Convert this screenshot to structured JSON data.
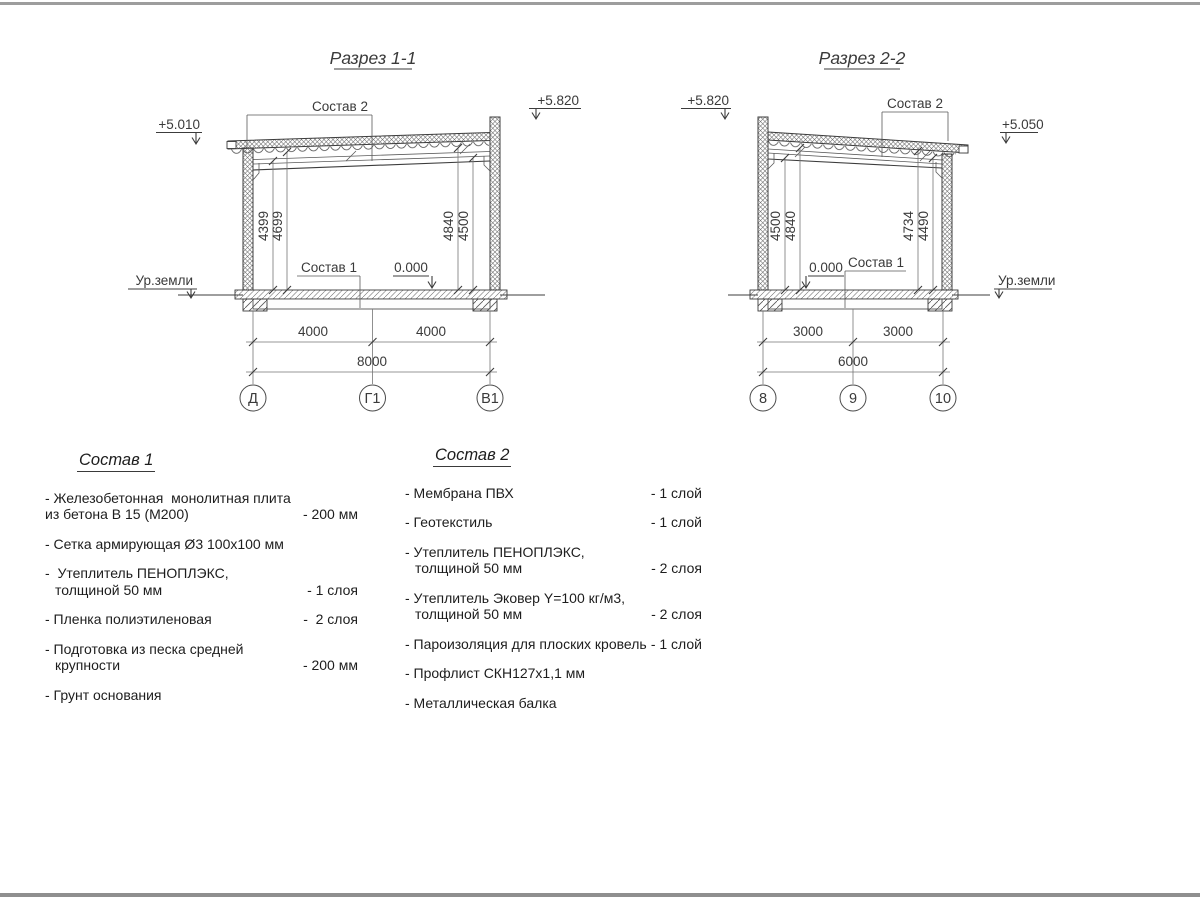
{
  "sections": [
    {
      "title": "Разрез 1-1",
      "elev_left": "+5.010",
      "elev_right": "+5.820",
      "roof_callout": "Состав 2",
      "floor_callout": "Состав 1",
      "zero_mark": "0.000",
      "ground_label": "Ур.земли",
      "dim_labels": {
        "left_inner": [
          "4399",
          "4699"
        ],
        "right_inner": [
          "4840",
          "4500"
        ],
        "span1": "4000",
        "span2": "4000",
        "total": "8000"
      },
      "axes": [
        "Д",
        "Г1",
        "В1"
      ]
    },
    {
      "title": "Разрез 2-2",
      "elev_left": "+5.820",
      "elev_right": "+5.050",
      "roof_callout": "Состав 2",
      "floor_callout": "Состав 1",
      "zero_mark": "0.000",
      "ground_label": "Ур.земли",
      "dim_labels": {
        "left_inner": [
          "4500",
          "4840"
        ],
        "right_inner": [
          "4734",
          "4490"
        ],
        "span1": "3000",
        "span2": "3000",
        "total": "6000"
      },
      "axes": [
        "8",
        "9",
        "10"
      ]
    }
  ],
  "legends": [
    {
      "title": "Состав 1",
      "items": [
        {
          "text": "- Железобетонная  монолитная плита",
          "text2": "из бетона В 15 (М200)",
          "qty": "- 200 мм"
        },
        {
          "text": "- Сетка армирующая Ø3 100х100 мм"
        },
        {
          "text": "-  Утеплитель ПЕНОПЛЭКС,",
          "text2": "толщиной 50 мм",
          "qty": "- 1 слоя"
        },
        {
          "text": "- Пленка полиэтиленовая",
          "qty": "-  2 слоя"
        },
        {
          "text": "- Подготовка из песка средней",
          "text2": "крупности",
          "qty": "- 200 мм"
        },
        {
          "text": "- Грунт основания"
        }
      ]
    },
    {
      "title": "Состав 2",
      "items": [
        {
          "text": "- Мембрана ПВХ",
          "qty": "- 1 слой"
        },
        {
          "text": "- Геотекстиль",
          "qty": "- 1 слой"
        },
        {
          "text": "- Утеплитель ПЕНОПЛЭКС,",
          "text2": "толщиной 50 мм",
          "qty": "- 2 слоя"
        },
        {
          "text": "- Утеплитель Эковер Y=100 кг/м3,",
          "text2": "толщиной 50 мм",
          "qty": "- 2 слоя"
        },
        {
          "text": "- Пароизоляция для плоских кровель",
          "qty": "- 1 слой"
        },
        {
          "text": "- Профлист СКН127х1,1 мм"
        },
        {
          "text": "- Металлическая балка"
        }
      ]
    }
  ]
}
